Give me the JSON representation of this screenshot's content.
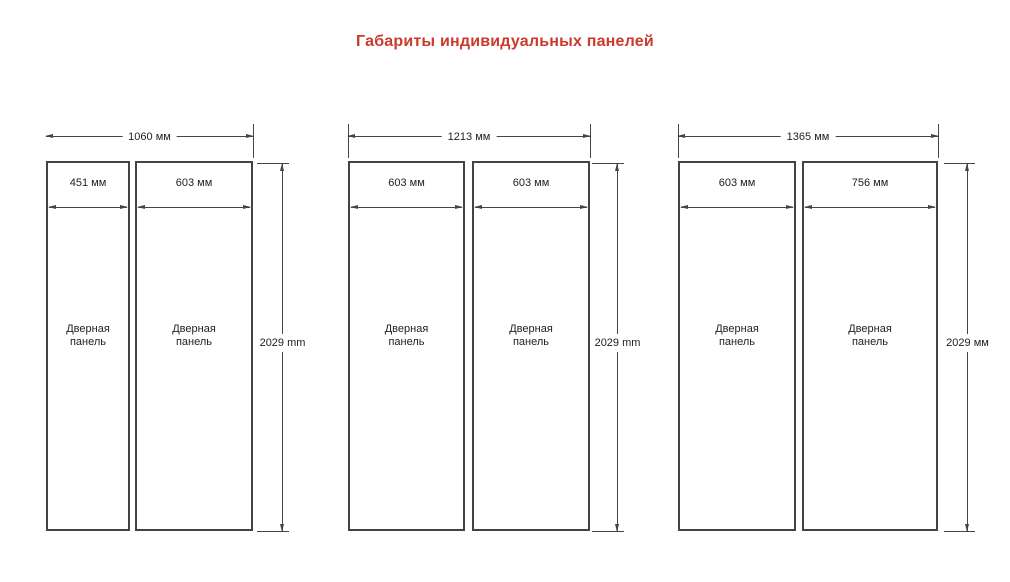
{
  "title": "Габариты индивидуальных панелей",
  "colors": {
    "accent": "#cb3a2c",
    "line": "#454545"
  },
  "panel_label": "Дверная панель",
  "groups": [
    {
      "overall_width": "1060 мм",
      "height": "2029 mm",
      "panels": [
        {
          "width": "451 мм",
          "label": "Дверная панель"
        },
        {
          "width": "603 мм",
          "label": "Дверная панель"
        }
      ]
    },
    {
      "overall_width": "1213 мм",
      "height": "2029 mm",
      "panels": [
        {
          "width": "603 мм",
          "label": "Дверная панель"
        },
        {
          "width": "603 мм",
          "label": "Дверная панель"
        }
      ]
    },
    {
      "overall_width": "1365 мм",
      "height": "2029 мм",
      "panels": [
        {
          "width": "603 мм",
          "label": "Дверная панель"
        },
        {
          "width": "756 мм",
          "label": "Дверная панель"
        }
      ]
    }
  ]
}
